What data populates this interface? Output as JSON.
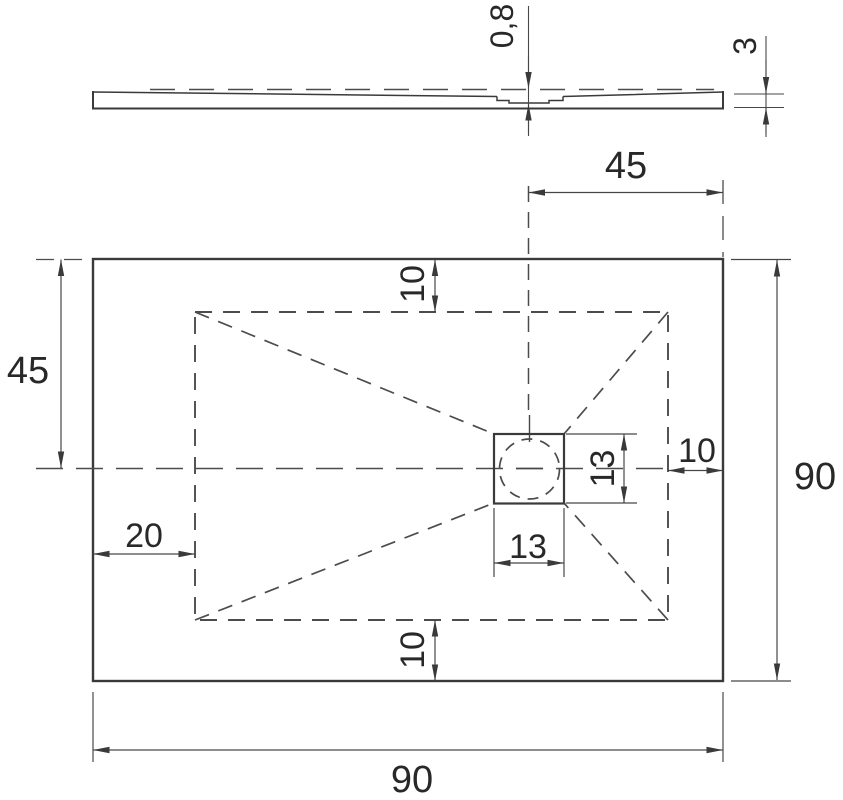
{
  "colors": {
    "line_color": "#3a3a3a",
    "dimension_line_color": "#474747",
    "text_color": "#282828",
    "background": "#ffffff"
  },
  "labels": {
    "recess_depth": "0,8",
    "edge_thickness": "3",
    "drain_center_from_right": "45",
    "drain_center_from_top": "45",
    "overall_width": "90",
    "overall_length": "90",
    "inset_top": "10",
    "inset_bottom": "10",
    "inset_right": "10",
    "inset_left": "20",
    "drain_width": "13",
    "drain_height": "13"
  }
}
